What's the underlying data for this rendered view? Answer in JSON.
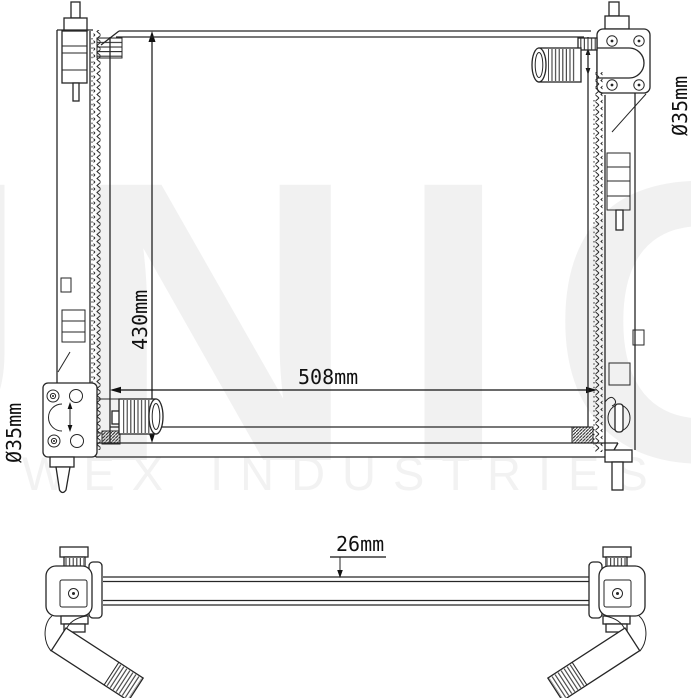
{
  "labels": {
    "height": "430mm",
    "width": "508mm",
    "inlet_diameter": "Ø35mm",
    "outlet_diameter": "Ø35mm",
    "core_thickness": "26mm"
  },
  "watermark": {
    "brand": "UNIC",
    "subtitle": "WEX INDUSTRIES"
  },
  "colors": {
    "line": "#262626",
    "background": "#ffffff",
    "watermark": "#f1f1f1"
  }
}
